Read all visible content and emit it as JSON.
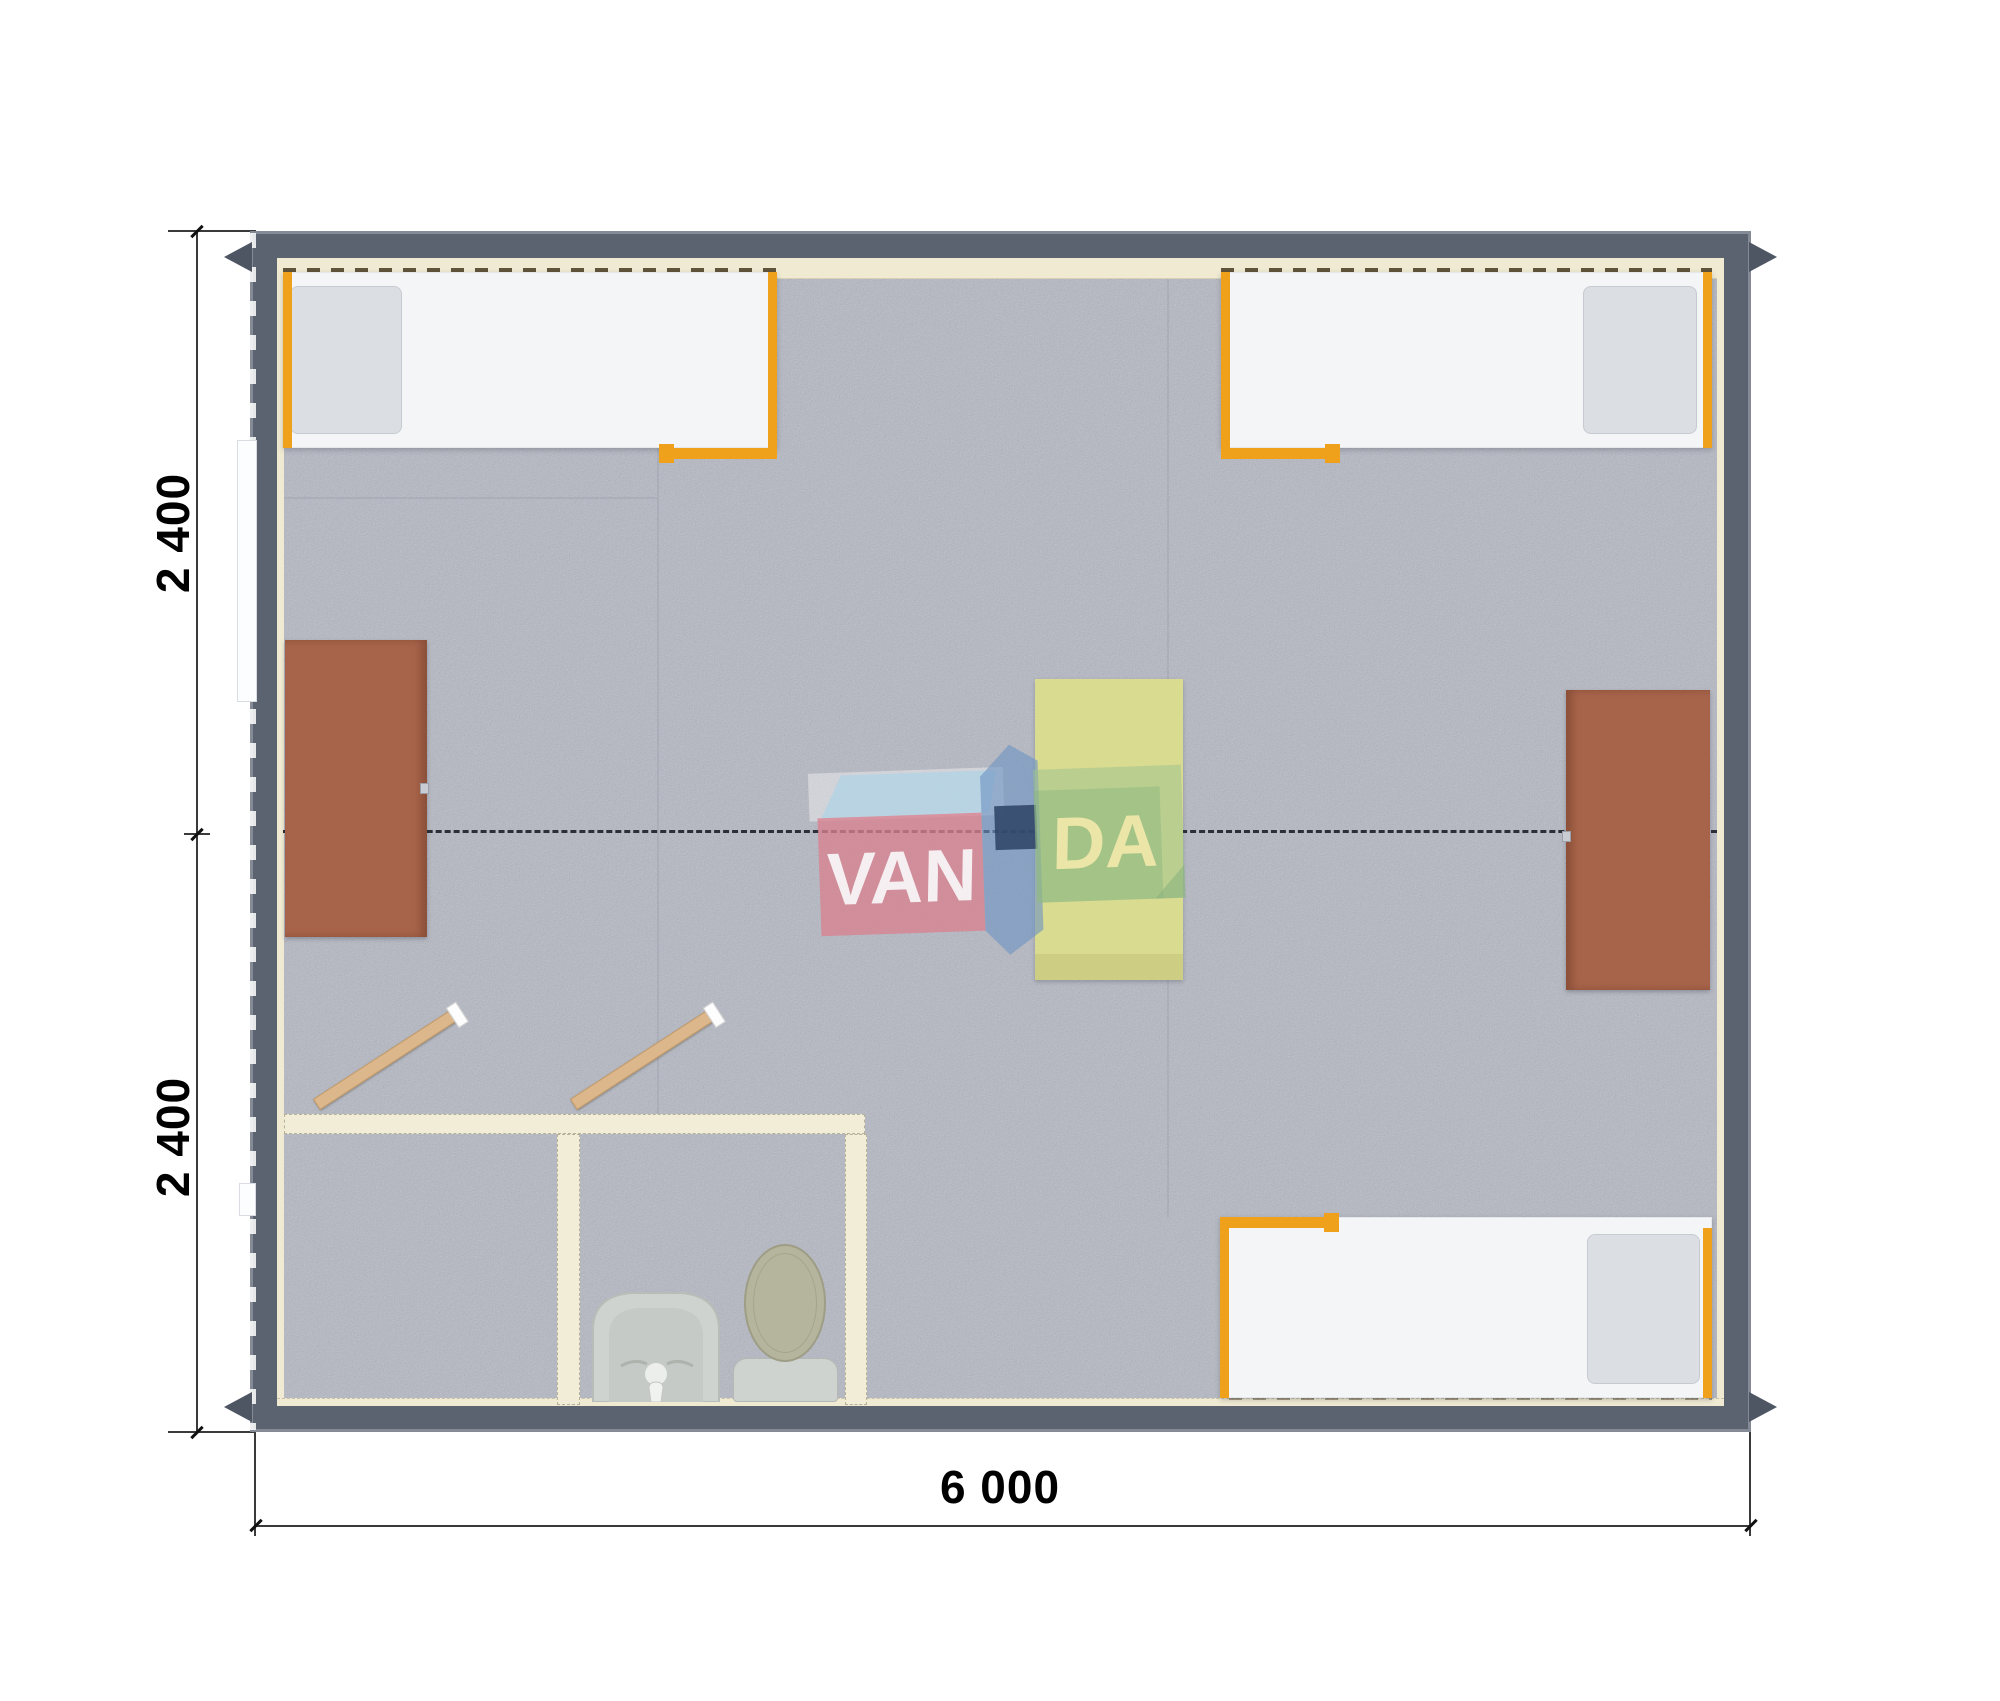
{
  "dimensions": {
    "left_top": "2 400",
    "left_bottom": "2 400",
    "bottom_width": "6 000"
  },
  "watermark": {
    "full_name": "VANDA",
    "part_van": "VAN",
    "part_da": "DA"
  },
  "colors": {
    "wall": "#5b6270",
    "wall_edge": "#848a96",
    "floor": "#b4b8c3",
    "lining_cream": "#f0ead3",
    "accent_orange": "#f0a11c",
    "bed_white": "#f3f5f7",
    "pillow_gray": "#dbdfe4",
    "desk_brown": "#a7644b",
    "table_yellow": "#d9db90",
    "table_yellow_dark": "#c7c97d",
    "partition_cream": "#f2edd6",
    "door_wood": "#dcb78c",
    "fixture_gray": "#cfd3cf",
    "fixture_inner": "#c5cac6",
    "toilet_lid_olive": "#b5b49c",
    "axis_dash": "#2c2f36",
    "dim_line": "#3a3a3a",
    "logo_pink": "#d9818f",
    "logo_topface": "#aed3e6",
    "logo_blue": "#6f94c4",
    "logo_navy": "#2f4568",
    "logo_green": "#9cc48e",
    "logo_green_dark": "#8ab37e",
    "logo_van_text": "rgba(249,250,252,0.9)",
    "logo_da_text": "rgba(239,232,170,0.95)"
  }
}
